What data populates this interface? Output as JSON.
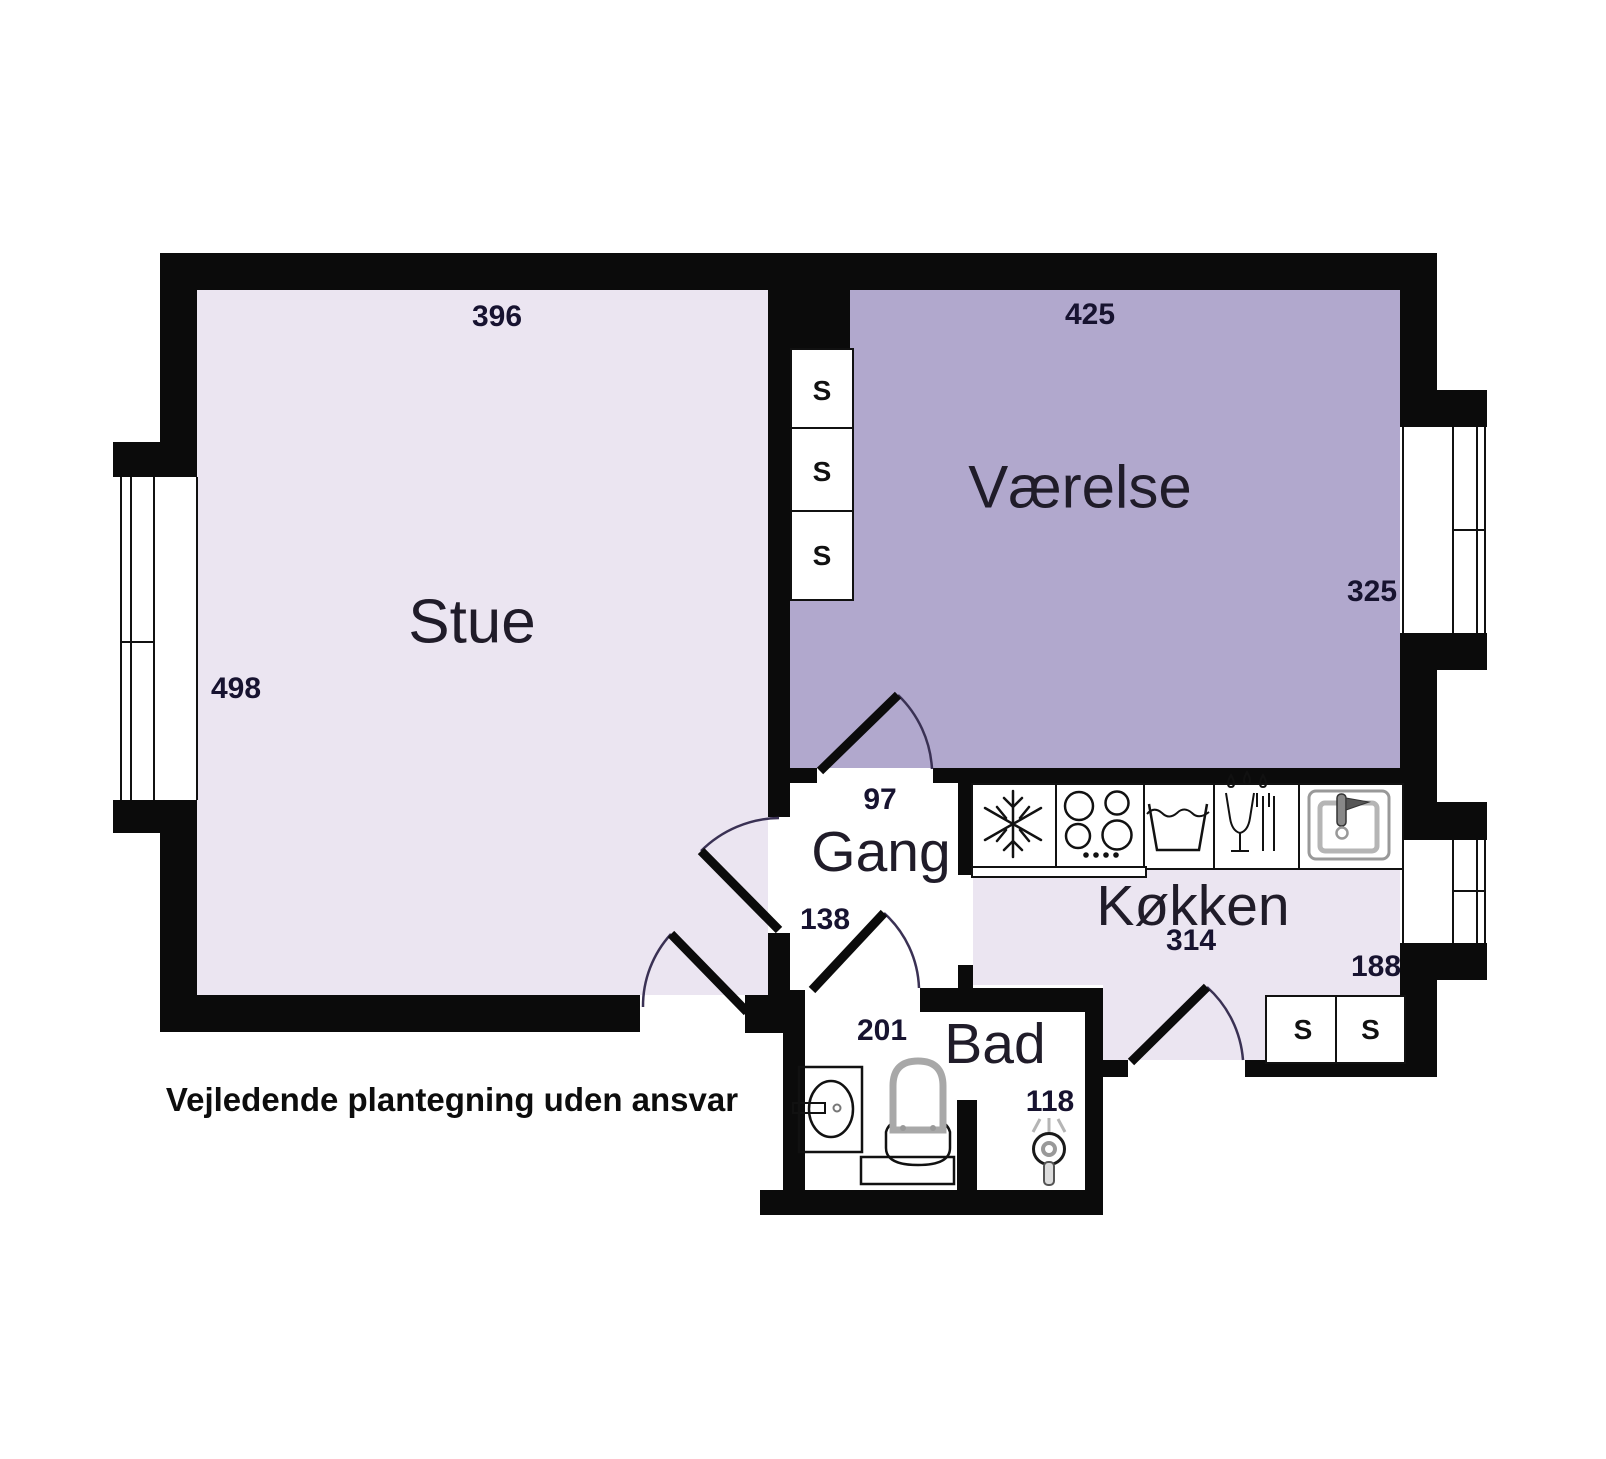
{
  "footer": {
    "text": "Vejledende plantegning uden ansvar"
  },
  "rooms": {
    "stue": {
      "name": "Stue",
      "width_cm": "396",
      "depth_cm": "498"
    },
    "vaerelse": {
      "name": "Værelse",
      "width_cm": "425",
      "depth_cm": "325"
    },
    "gang": {
      "name": "Gang",
      "width_cm": "97",
      "lower_width_cm": "138"
    },
    "koekken": {
      "name": "Køkken",
      "width_cm": "314",
      "right_wall_cm": "188"
    },
    "bad": {
      "name": "Bad",
      "width_cm": "201",
      "shower_width_cm": "118"
    }
  },
  "closet": {
    "label": "S"
  },
  "icons": {
    "freezer": "snowflake-icon",
    "stove": "stove-burners-icon",
    "prep_basin": "basin-icon",
    "dishwasher": "dishwasher-icon",
    "kitchen_sink": "sink-icon",
    "bath_sink": "washbasin-icon",
    "toilet": "toilet-icon",
    "shower": "shower-icon"
  },
  "colors": {
    "wall": "#0b0b0b",
    "room_light": "#ebe5f1",
    "room_dark": "#b1a8cd",
    "door_arc": "#3a3154",
    "fixture_gray": "#b5b5b5"
  }
}
